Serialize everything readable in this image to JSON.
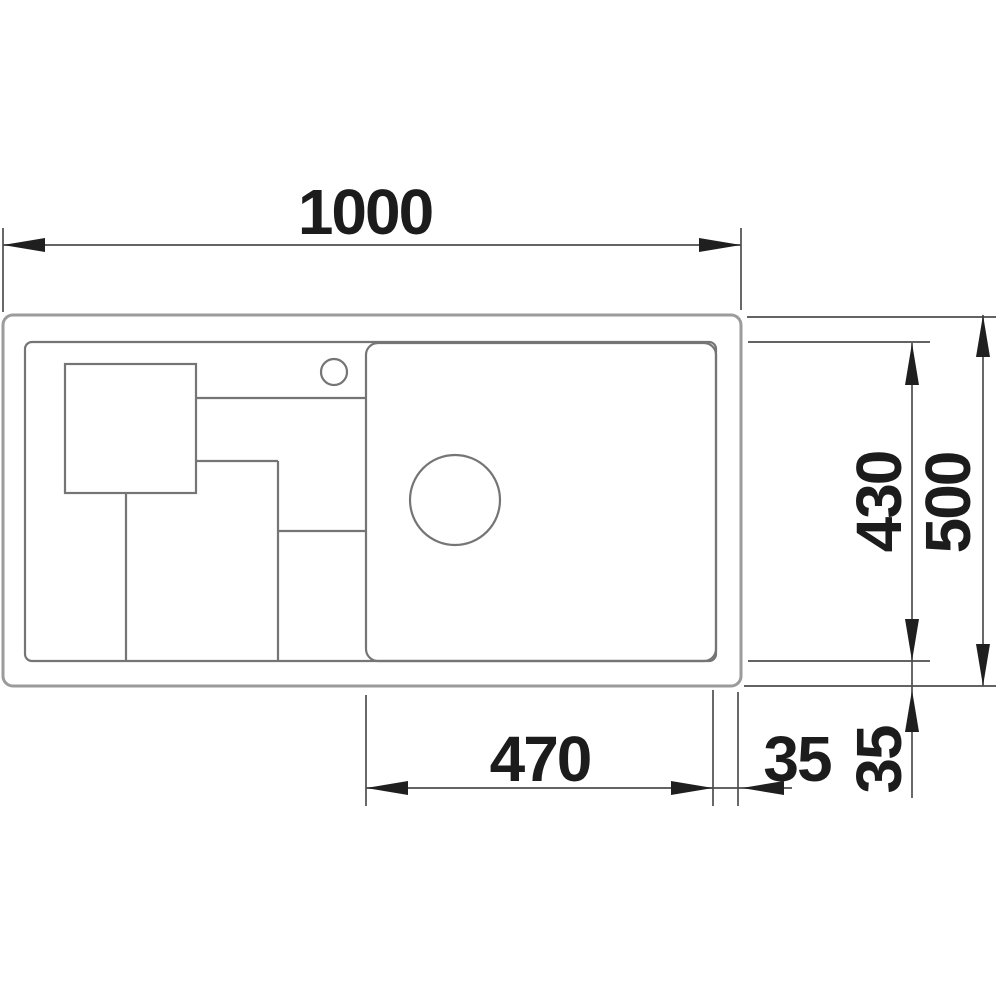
{
  "drawing": {
    "kind": "sink plan technical drawing",
    "dimensions": {
      "overall_width": "1000",
      "bowl_width": "470",
      "inner_depth": "430",
      "overall_depth": "500",
      "rim_side": "35",
      "rim_front": "35"
    },
    "colors": {
      "background": "#ffffff",
      "outer_outline": "#9b9b9b",
      "inner_lines": "#757575",
      "dimension_lines": "#4d4d4d",
      "arrows_and_text": "#1c1c1c"
    }
  }
}
